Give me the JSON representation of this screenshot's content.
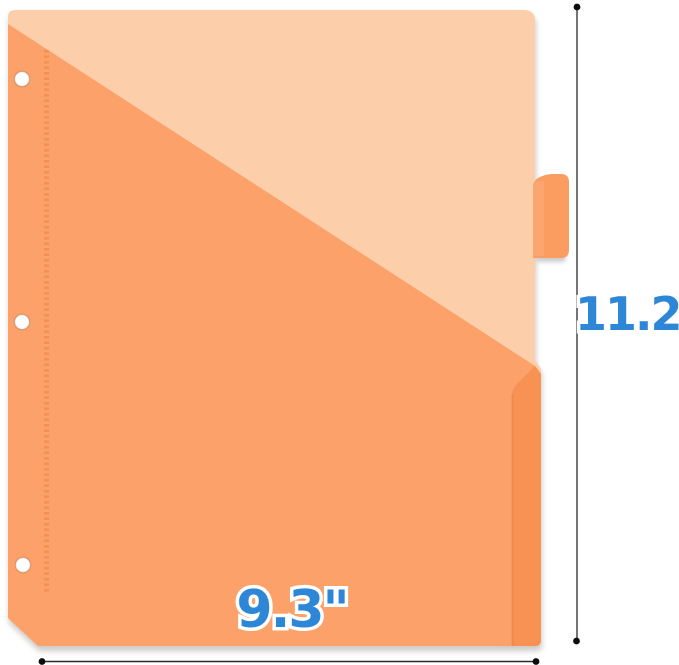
{
  "dimensions": {
    "height_label": "11.2\"",
    "width_label": "9.3\""
  },
  "colors": {
    "sheet_front": "#fccfaa",
    "pocket": "#fba169",
    "pocket_fold": "#f79154",
    "pocket_seam": "#ee8044",
    "tab": "#fb9c61",
    "stitch": "#e87f3e",
    "hole": "#ffffff",
    "dimension_text": "#2e86d6",
    "dimension_line": "#2b2b2b",
    "dimension_dot": "#0d0d0d",
    "shadow": "#9c948e"
  }
}
